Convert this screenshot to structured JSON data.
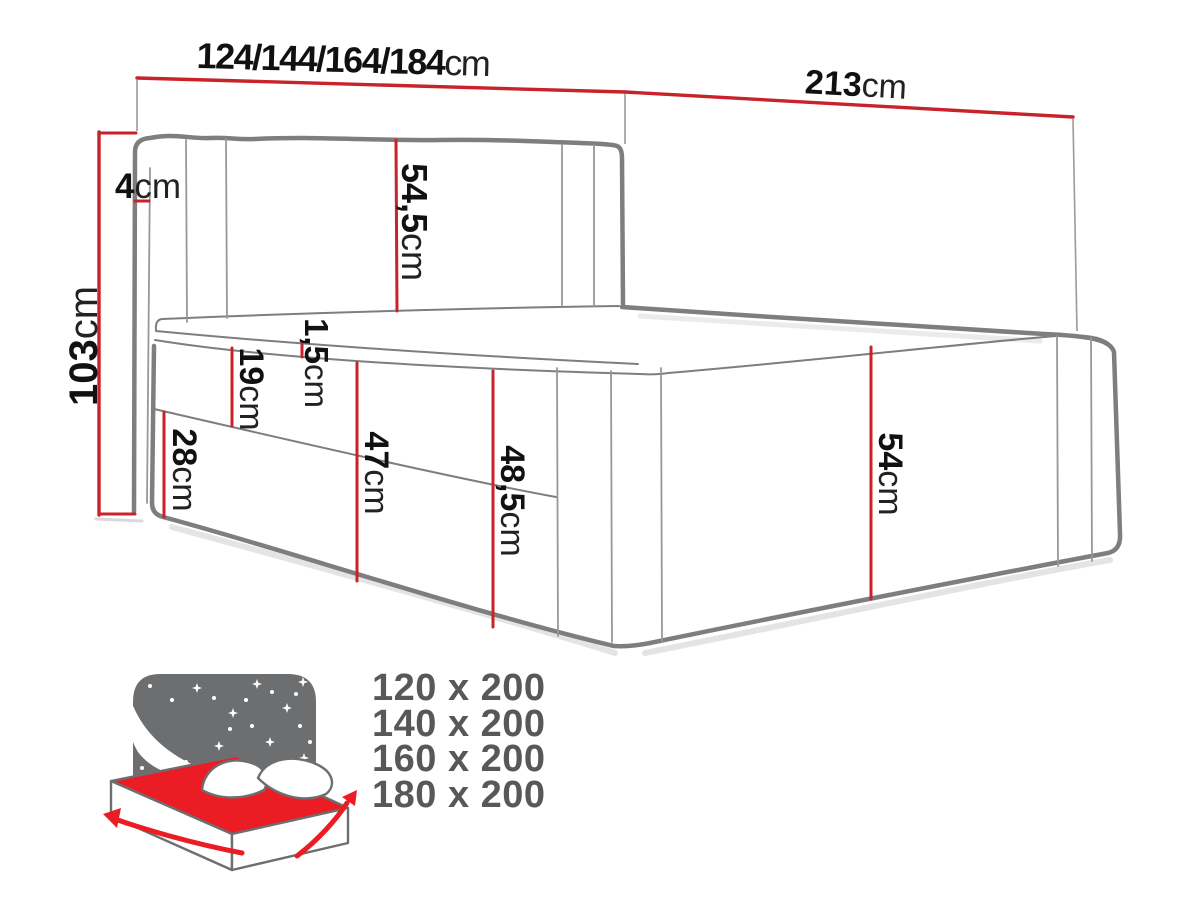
{
  "diagram_title": "bed-dimensions",
  "dimensions": {
    "width_options": {
      "value": "124/144/164/184",
      "unit": "cm"
    },
    "length": {
      "value": "213",
      "unit": "cm"
    },
    "total_height": {
      "value": "103",
      "unit": "cm"
    },
    "headboard_wing": {
      "value": "4",
      "unit": "cm"
    },
    "headboard_above": {
      "value": "54,5",
      "unit": "cm"
    },
    "mattress_lip": {
      "value": "1,5",
      "unit": "cm"
    },
    "upper_frame": {
      "value": "19",
      "unit": "cm"
    },
    "drawer_front": {
      "value": "28",
      "unit": "cm"
    },
    "side_front_height": {
      "value": "47",
      "unit": "cm"
    },
    "side_total_height": {
      "value": "48,5",
      "unit": "cm"
    },
    "foot_side_height": {
      "value": "54",
      "unit": "cm"
    }
  },
  "available_sizes": [
    "120 x 200",
    "140 x 200",
    "160 x 200",
    "180 x 200"
  ],
  "colors": {
    "dimension_red": "#c8222a",
    "outline_gray": "#7e7e80",
    "seam_gray": "#98989b",
    "icon_gray": "#6d6e70",
    "icon_red": "#ec1c24",
    "sizes_text_gray": "#58585a"
  }
}
